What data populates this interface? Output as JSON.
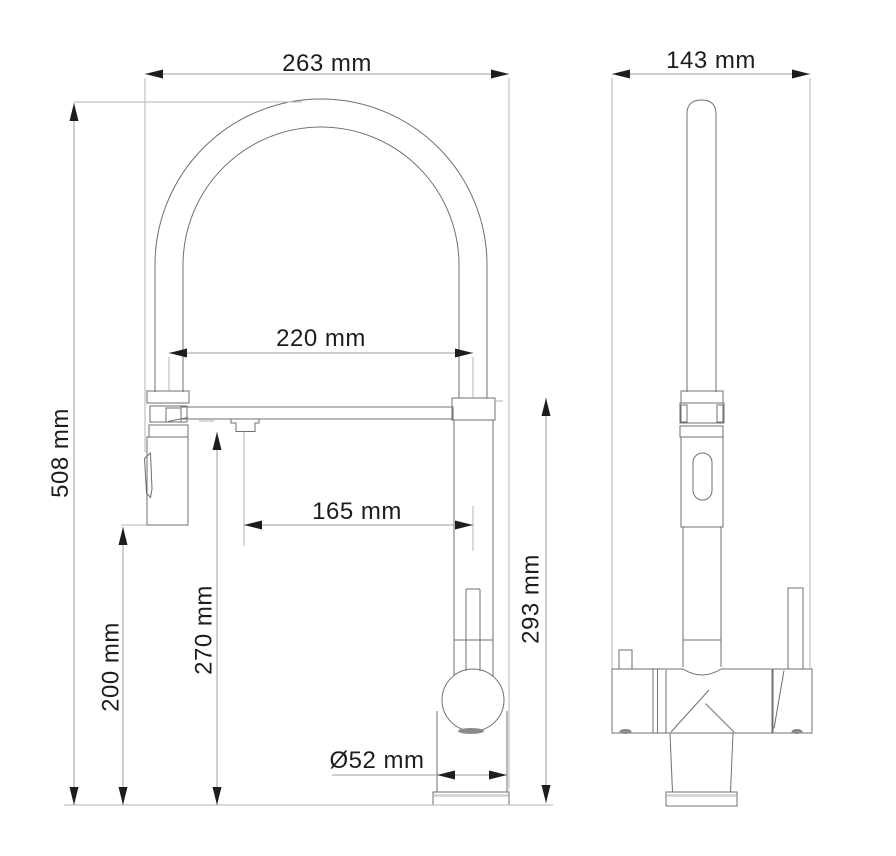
{
  "drawing": {
    "type": "technical-dimension-drawing",
    "subject": "Kitchen mixer faucet with pull-down spray head, front view and side view",
    "unit": "mm"
  },
  "colors": {
    "background": "#ffffff",
    "object_line": "#6f6f6f",
    "extension_line": "#b6b6b6",
    "dimension_line": "#9c9c9c",
    "annotation": "#1d1d1d",
    "shading": "#8a8a8a",
    "plate_line": "#cfcfcf"
  },
  "dimensions": {
    "overall_width": {
      "label": "263 mm",
      "value": 263,
      "orientation": "horizontal",
      "view": "front"
    },
    "overall_height": {
      "label": "508 mm",
      "value": 508,
      "orientation": "vertical",
      "view": "front"
    },
    "hose_span": {
      "label": "220 mm",
      "value": 220,
      "orientation": "horizontal",
      "view": "front"
    },
    "spout_reach": {
      "label": "165 mm",
      "value": 165,
      "orientation": "horizontal",
      "view": "front"
    },
    "spout_outlet_height": {
      "label": "270 mm",
      "value": 270,
      "orientation": "vertical",
      "view": "front"
    },
    "head_bottom_height": {
      "label": "200 mm",
      "value": 200,
      "orientation": "vertical",
      "view": "front"
    },
    "body_height": {
      "label": "293 mm",
      "value": 293,
      "orientation": "vertical",
      "view": "front"
    },
    "base_diameter": {
      "label": "Ø52 mm",
      "value": 52,
      "orientation": "horizontal",
      "view": "front"
    },
    "side_overall_width": {
      "label": "143 mm",
      "value": 143,
      "orientation": "horizontal",
      "view": "side"
    }
  }
}
